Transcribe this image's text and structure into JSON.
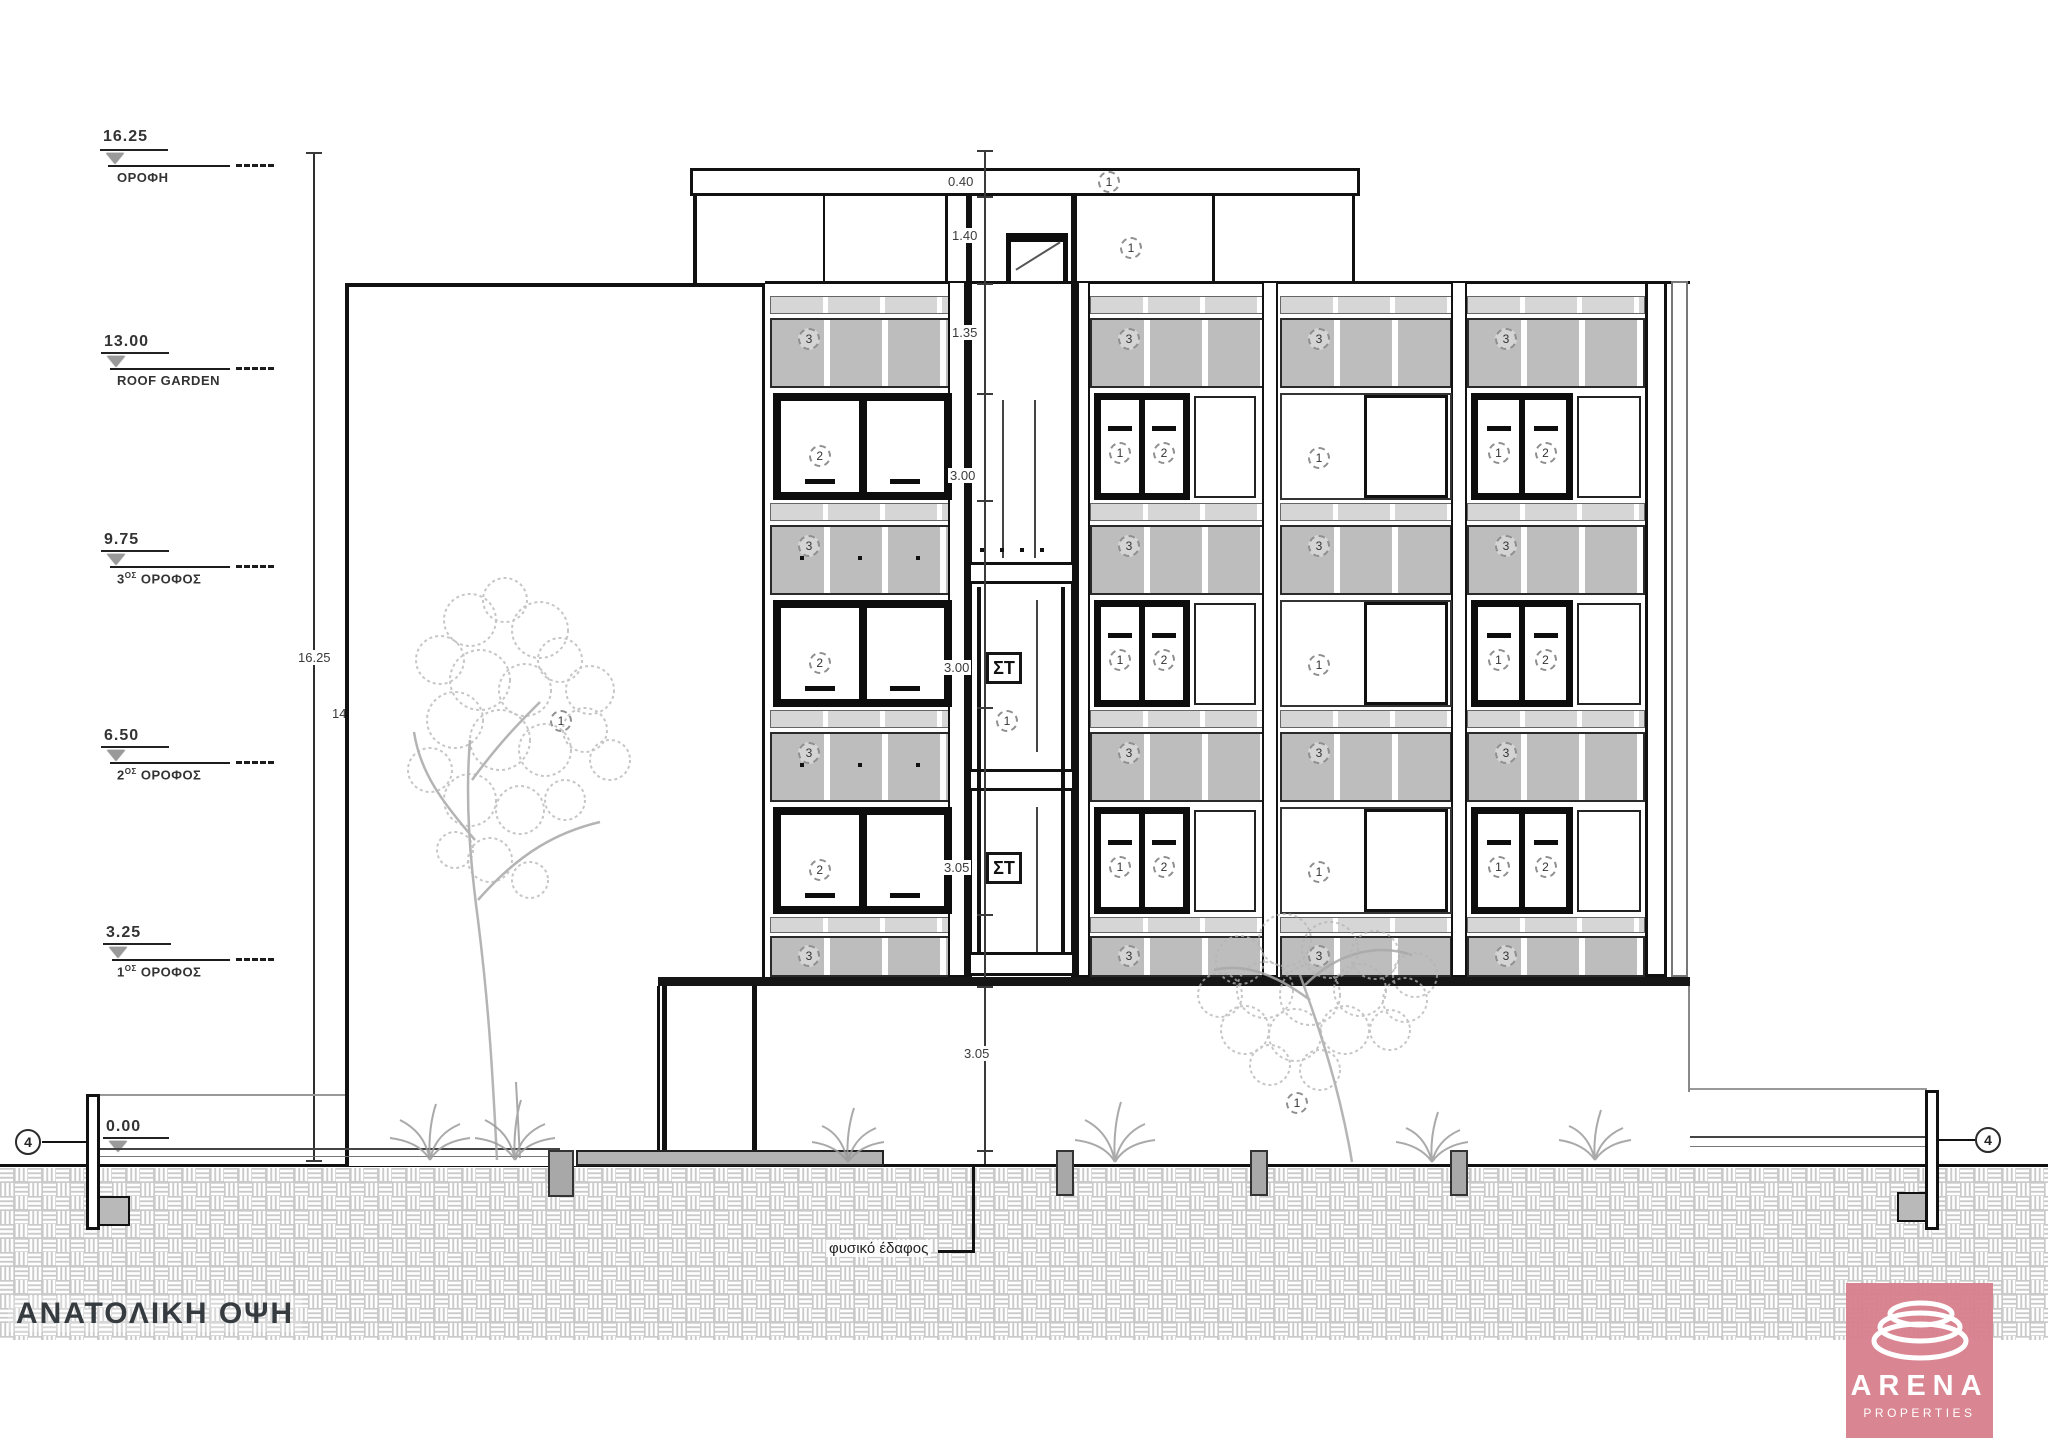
{
  "title": "ΑΝΑΤΟΛΙΚΗ ΟΨΗ",
  "levels": [
    {
      "value": "16.25",
      "pre": "ΟΡΟΦΗ",
      "sup": "",
      "rest": ""
    },
    {
      "value": "13.00",
      "pre": "ROOF GARDEN",
      "sup": "",
      "rest": ""
    },
    {
      "value": "9.75",
      "pre": "3",
      "sup": "ΟΣ",
      "rest": " ΟΡΟΦΟΣ"
    },
    {
      "value": "6.50",
      "pre": "2",
      "sup": "ΟΣ",
      "rest": " ΟΡΟΦΟΣ"
    },
    {
      "value": "3.25",
      "pre": "1",
      "sup": "ΟΣ",
      "rest": " ΟΡΟΦΟΣ"
    },
    {
      "value": "0.00",
      "pre": "",
      "sup": "",
      "rest": ""
    }
  ],
  "dims": {
    "overall": "16.25",
    "wall": "14.40",
    "parapet": "0.40",
    "penthouse": "1.40",
    "railing": "1.35",
    "storey3": "3.00",
    "storey2": "3.00",
    "storey1": "3.05",
    "pilotis": "3.05"
  },
  "tags": {
    "one": "1",
    "two": "2",
    "three": "3",
    "four": "4",
    "stair": "ΣΤ"
  },
  "notes": {
    "ground": "φυσικό έδαφος"
  },
  "logo": {
    "brand": "ARENA",
    "sub": "PROPERTIES",
    "bg": "#d8808c"
  }
}
